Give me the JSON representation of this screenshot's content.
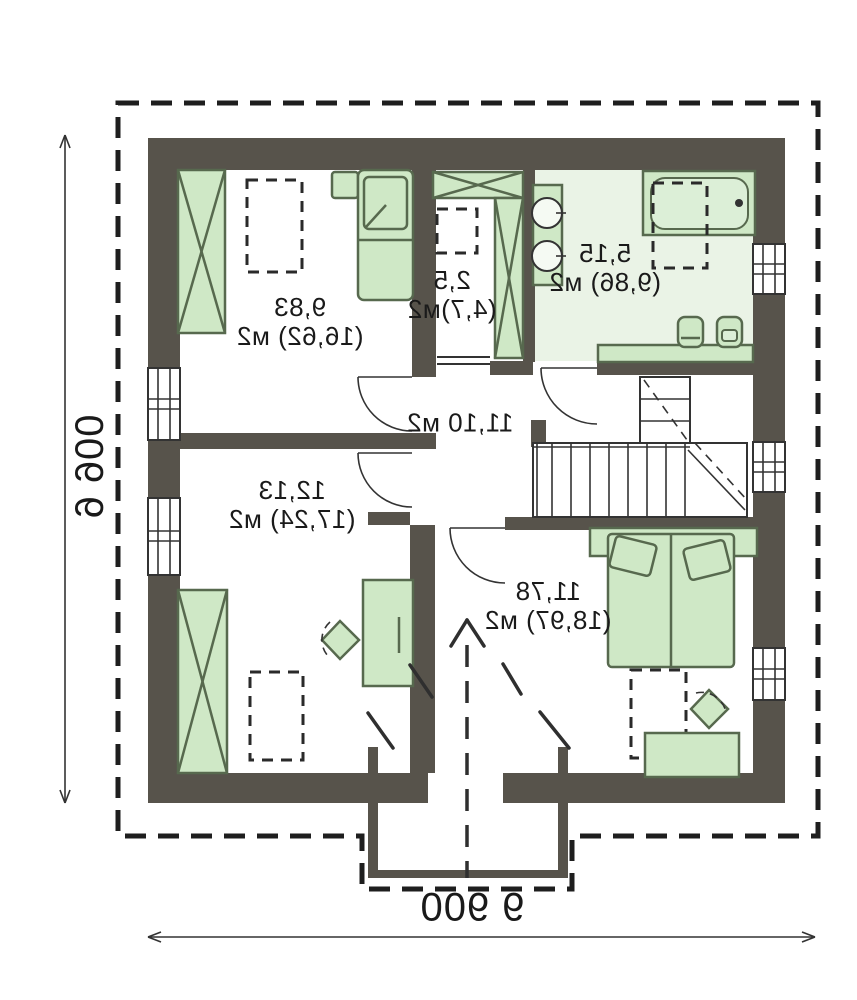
{
  "plan": {
    "rooms": [
      {
        "id": "bedroom-top-left",
        "line1": "9,83",
        "line2": "(16,62) м2"
      },
      {
        "id": "closet",
        "line1": "2,5",
        "line2": "(4,7)м2"
      },
      {
        "id": "bathroom",
        "line1": "5,15",
        "line2": "(9,86) м2"
      },
      {
        "id": "hall",
        "line1": "11,10 м2",
        "line2": ""
      },
      {
        "id": "bedroom-bottom-left",
        "line1": "12,13",
        "line2": "(17,24) м2"
      },
      {
        "id": "bedroom-bottom-right",
        "line1": "11,78",
        "line2": "(18,97) м2"
      }
    ],
    "dimensions": {
      "bottom": "9 900",
      "left": "9 900"
    },
    "colors": {
      "wall": "#57534b",
      "furniture_fill": "#cfe8c6",
      "furniture_stroke": "#57694e",
      "bathroom_floor": "#eaf3e6",
      "line": "#2a2a2a"
    }
  }
}
